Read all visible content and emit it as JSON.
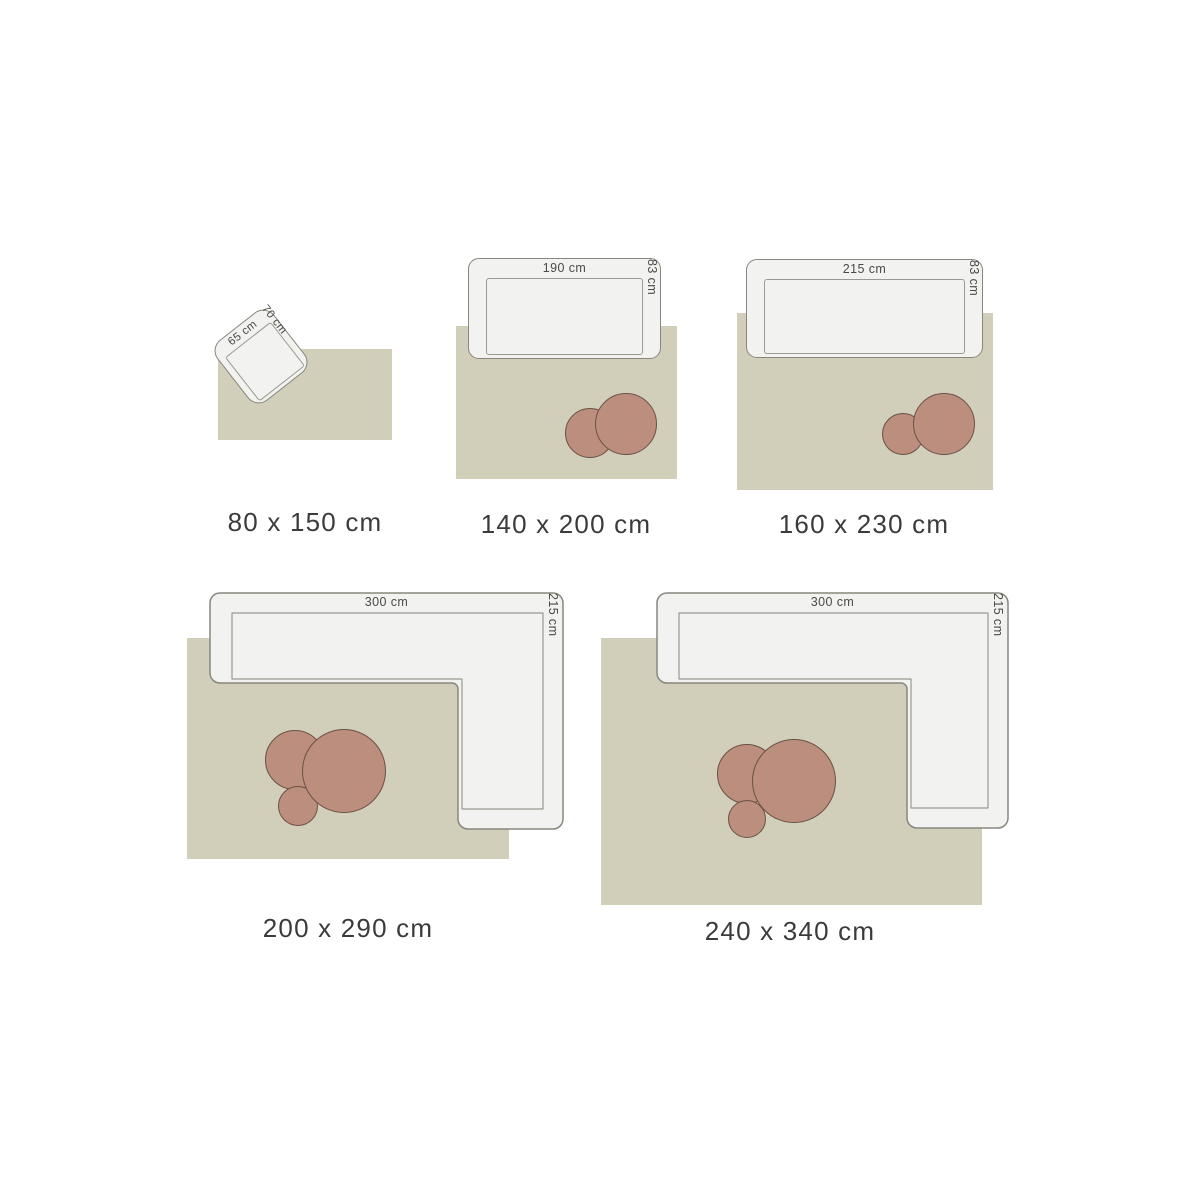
{
  "colors": {
    "background": "#ffffff",
    "rug": "#d1ceba",
    "furniture_fill": "#f2f2f0",
    "furniture_stroke": "#87877f",
    "seat_stroke": "#9a9a92",
    "table_fill": "#bc8e7d",
    "table_stroke": "#6a5146",
    "dim_text": "#4a4a46",
    "label_text": "#3b3b3b"
  },
  "sizes": [
    {
      "label": "80 x 150 cm",
      "furniture": {
        "type": "armchair",
        "width_label": "65 cm",
        "depth_label": "70 cm"
      },
      "tables": []
    },
    {
      "label": "140 x 200 cm",
      "furniture": {
        "type": "sofa",
        "width_label": "190 cm",
        "depth_label": "83 cm"
      },
      "tables": [
        "small",
        "large"
      ]
    },
    {
      "label": "160 x 230 cm",
      "furniture": {
        "type": "sofa",
        "width_label": "215 cm",
        "depth_label": "83 cm"
      },
      "tables": [
        "small",
        "large"
      ]
    },
    {
      "label": "200 x 290 cm",
      "furniture": {
        "type": "corner-sofa",
        "width_label": "300 cm",
        "depth_label": "215 cm"
      },
      "tables": [
        "medium",
        "small",
        "large"
      ]
    },
    {
      "label": "240 x 340 cm",
      "furniture": {
        "type": "corner-sofa",
        "width_label": "300 cm",
        "depth_label": "215 cm"
      },
      "tables": [
        "medium",
        "small",
        "large"
      ]
    }
  ]
}
